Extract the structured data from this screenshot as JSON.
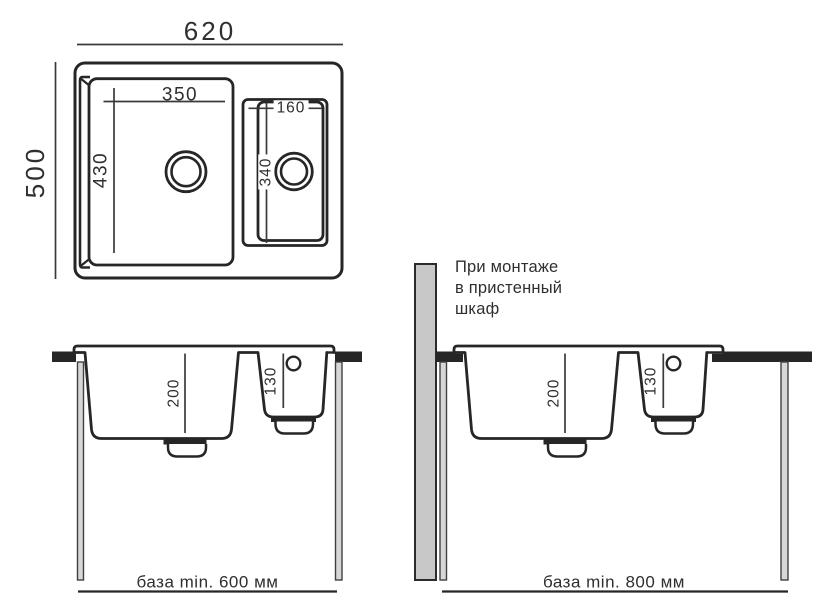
{
  "top_view": {
    "width_label": "620",
    "height_label": "500",
    "main_bowl_width_label": "350",
    "main_bowl_height_label": "430",
    "second_bowl_width_label": "160",
    "second_bowl_height_label": "340"
  },
  "front_section_left": {
    "main_bowl_depth_label": "200",
    "second_bowl_depth_label": "130",
    "base_label": "база min. 600 мм"
  },
  "front_section_right": {
    "main_bowl_depth_label": "200",
    "second_bowl_depth_label": "130",
    "base_label": "база min. 800 мм",
    "note_lines": [
      "При монтаже",
      "в пристенный",
      "шкаф"
    ]
  },
  "colors": {
    "line": "#262626",
    "dim_line": "#3a3a3a",
    "text": "#2f2f2f",
    "countertop": "#262626",
    "wall_panel_fill": "#c8c8c8",
    "cabinet_side_fill": "#d7d7d7",
    "background": "#ffffff"
  }
}
